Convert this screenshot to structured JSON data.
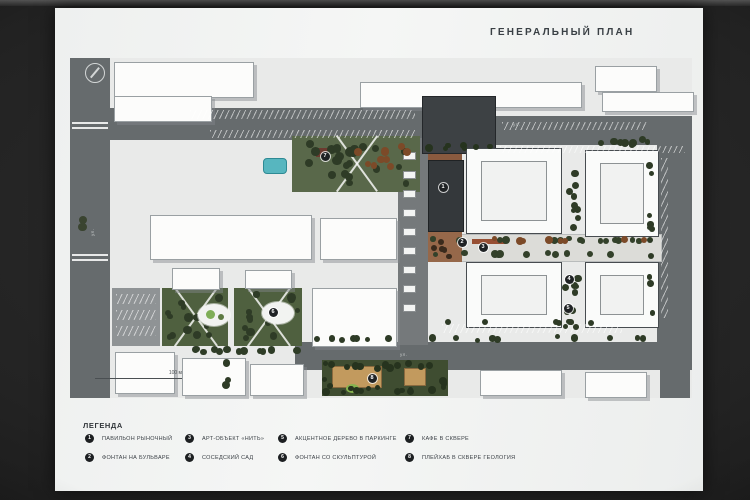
{
  "slide": {
    "title": "ГЕНЕРАЛЬНЫЙ ПЛАН",
    "scale_label": "100 м"
  },
  "map": {
    "road_labels": [
      {
        "id": "top-street",
        "text": "ул."
      },
      {
        "id": "bottom-street",
        "text": "ул."
      },
      {
        "id": "left-street",
        "text": "ул."
      }
    ],
    "markers": [
      {
        "num": "1",
        "x": 373,
        "y": 129
      },
      {
        "num": "2",
        "x": 392,
        "y": 184
      },
      {
        "num": "3",
        "x": 413,
        "y": 189
      },
      {
        "num": "4",
        "x": 499,
        "y": 221
      },
      {
        "num": "5",
        "x": 498,
        "y": 250
      },
      {
        "num": "6",
        "x": 203,
        "y": 254
      },
      {
        "num": "7",
        "x": 255,
        "y": 98
      },
      {
        "num": "8",
        "x": 302,
        "y": 320
      }
    ]
  },
  "legend": {
    "heading": "ЛЕГЕНДА",
    "items": [
      {
        "num": "1",
        "label": "ПАВИЛЬОН РЫНОЧНЫЙ",
        "col": 0,
        "row": 0
      },
      {
        "num": "2",
        "label": "ФОНТАН НА БУЛЬВАРЕ",
        "col": 0,
        "row": 1
      },
      {
        "num": "3",
        "label": "АРТ-ОБЪЕКТ «НИТЬ»",
        "col": 1,
        "row": 0
      },
      {
        "num": "4",
        "label": "СОСЕДСКИЙ САД",
        "col": 1,
        "row": 1
      },
      {
        "num": "5",
        "label": "АКЦЕНТНОЕ ДЕРЕВО В ПАРКИНГЕ",
        "col": 2,
        "row": 0
      },
      {
        "num": "6",
        "label": "ФОНТАН СО СКУЛЬПТУРОЙ",
        "col": 2,
        "row": 1
      },
      {
        "num": "7",
        "label": "КАФЕ В СКВЕРЕ",
        "col": 3,
        "row": 0
      },
      {
        "num": "8",
        "label": "ПЛЕЙХАБ В СКВЕРЕ ГЕОЛОГИЯ",
        "col": 3,
        "row": 1
      }
    ]
  },
  "colors": {
    "road": "#666b6d",
    "park_green": "#4f603f",
    "tree_dark": "#2e3b26",
    "tree_rust": "#7c4a28",
    "water": "#57b6bf",
    "pavilion": "#34383b",
    "marker": "#1f2224"
  }
}
